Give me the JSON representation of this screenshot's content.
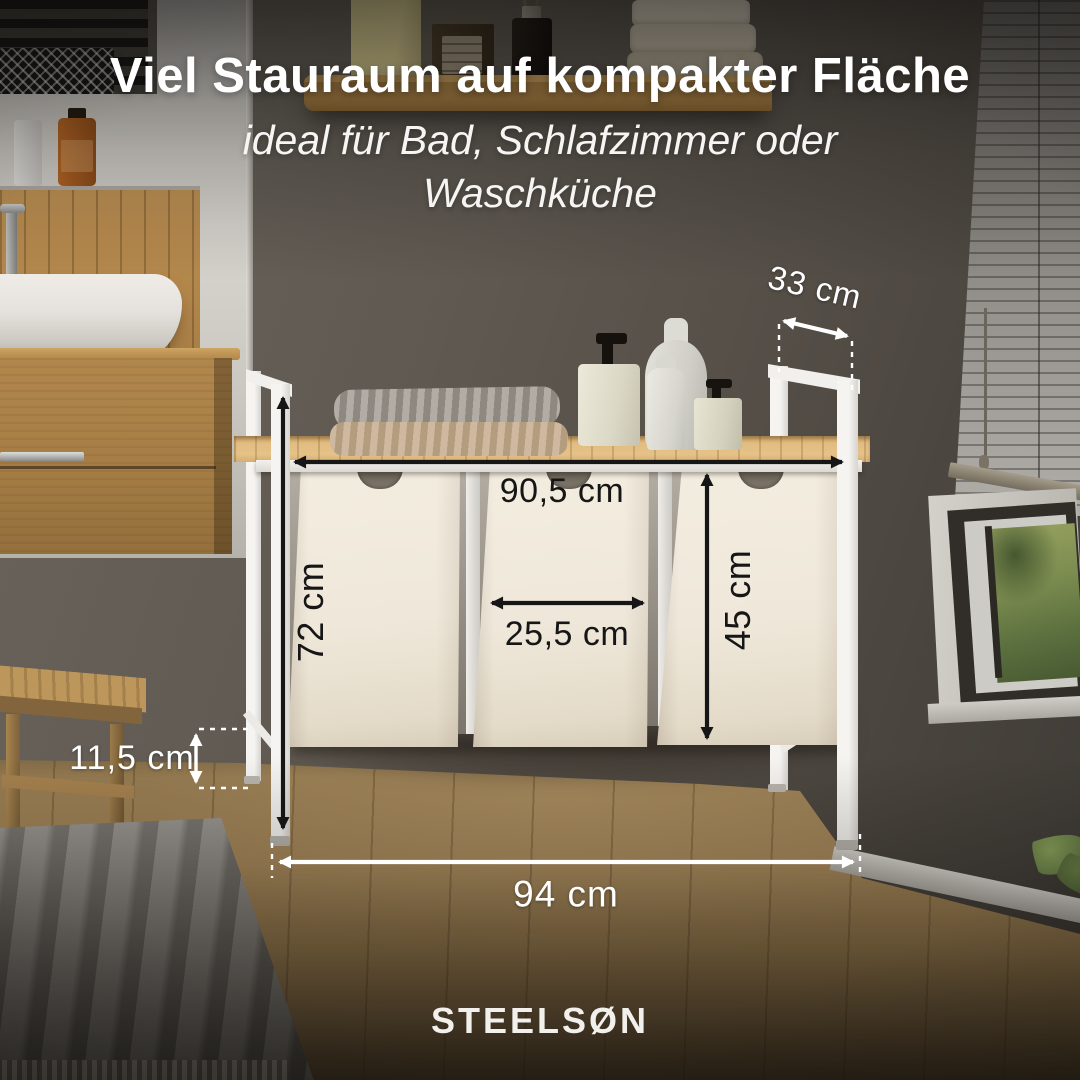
{
  "header": {
    "title": "Viel Stauraum auf kompakter Fläche",
    "subtitle_line1": "ideal für Bad, Schlafzimmer oder",
    "subtitle_line2": "Waschküche"
  },
  "dimensions": {
    "top_depth": "33 cm",
    "top_width": "90,5 cm",
    "side_height": "72 cm",
    "basket_width": "25,5 cm",
    "basket_height": "45 cm",
    "ground_clearance": "11,5 cm",
    "total_width": "94 cm"
  },
  "brand": {
    "logo_text": "STEELSØN"
  },
  "colors": {
    "annotation_dark": "#161616",
    "annotation_light": "#ffffff",
    "frame_white": "#f1efec",
    "basket_beige": "#efe8db",
    "wood_top": "#ddb87c",
    "wall_taupe": "#57514a"
  }
}
